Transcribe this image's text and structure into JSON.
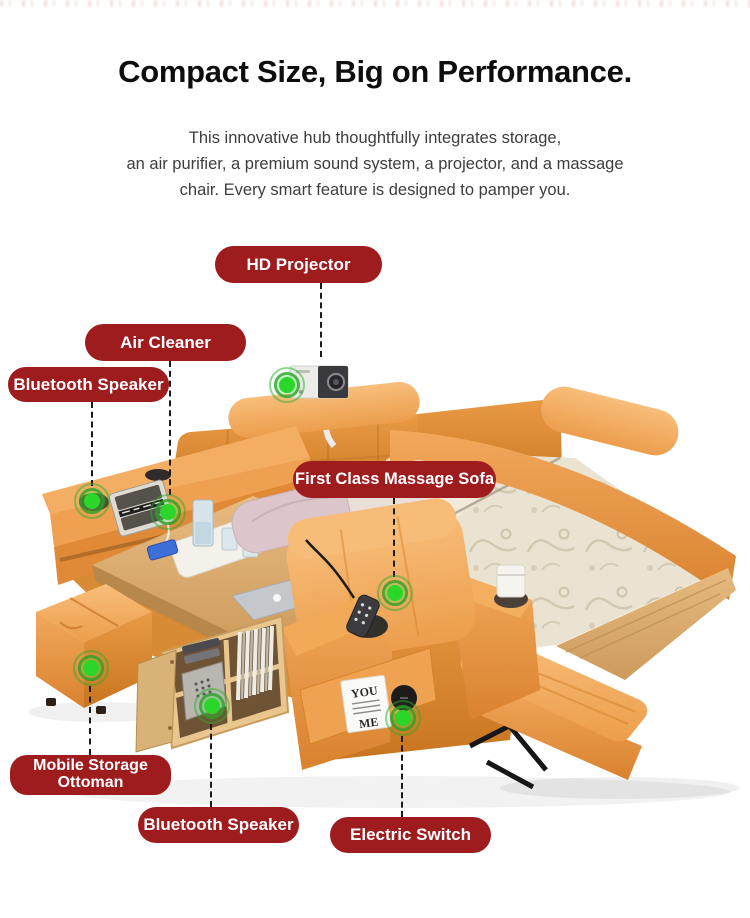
{
  "header": {
    "title": "Compact Size, Big on Performance.",
    "subtitle_lines": [
      "This innovative hub thoughtfully integrates storage,",
      "an air purifier, a premium sound system, a projector, and a massage",
      "chair. Every smart feature is designed to pamper you."
    ]
  },
  "figure": {
    "badges": [
      {
        "id": "hd-projector",
        "label": "HD Projector"
      },
      {
        "id": "air-cleaner",
        "label": "Air Cleaner"
      },
      {
        "id": "bluetooth-speaker-top",
        "label": "Bluetooth Speaker"
      },
      {
        "id": "first-class-massage-sofa",
        "label": "First Class Massage Sofa"
      },
      {
        "id": "mobile-storage-ottoman",
        "label": "Mobile Storage Ottoman"
      },
      {
        "id": "bluetooth-speaker-bottom",
        "label": "Bluetooth Speaker"
      },
      {
        "id": "electric-switch",
        "label": "Electric Switch"
      }
    ],
    "magazine_lines": [
      "YOU",
      "ME"
    ],
    "colors": {
      "badge_red": "#9E1B1E",
      "indicator_green": "#2BD62B",
      "leather_orange": "#E8953F",
      "wood": "#D8AE74",
      "mattress": "#EBE3D2"
    }
  }
}
